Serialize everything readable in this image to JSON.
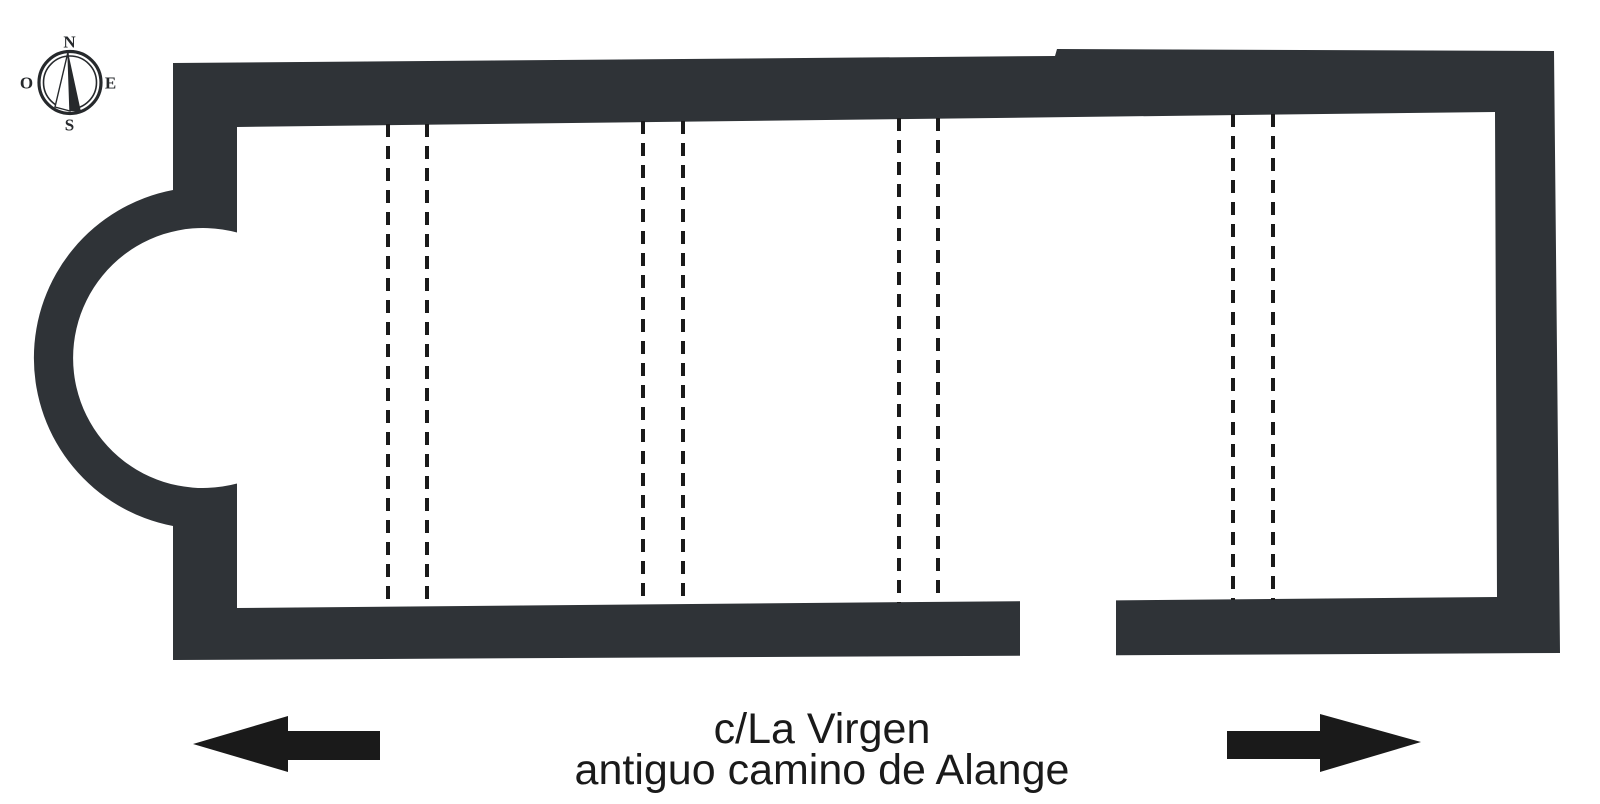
{
  "figure": {
    "kind": "architectural floor plan",
    "background_color": "#ffffff",
    "wall_color": "#2f3337",
    "ink_color": "#1a1a1a"
  },
  "compass": {
    "north": "N",
    "south": "S",
    "east": "E",
    "west": "O"
  },
  "street": {
    "line1": "c/La Virgen",
    "line2": "antiguo camino de Alange"
  },
  "plan": {
    "apse": {
      "side": "west",
      "shape": "horseshoe",
      "open_into": "nave"
    },
    "doorway": {
      "wall": "south",
      "x_from": 1020,
      "x_to": 1116
    },
    "bay_division_pairs": 4,
    "dashed_line_x_positions": [
      388,
      427,
      643,
      683,
      899,
      938,
      1233,
      1273
    ]
  }
}
